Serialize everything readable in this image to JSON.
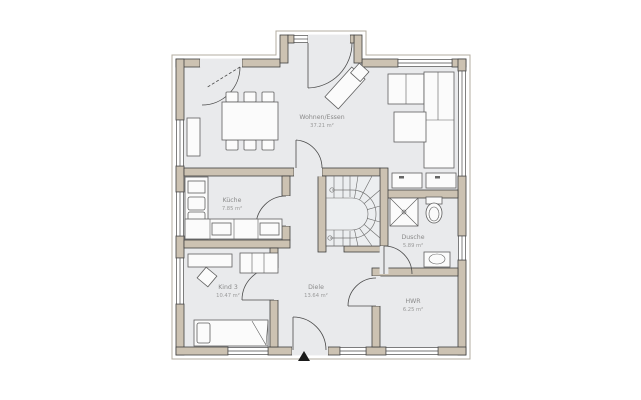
{
  "plan": {
    "rooms": [
      {
        "id": "wohnen-essen",
        "name": "Wohnen/Essen",
        "area": "37.21 m²"
      },
      {
        "id": "kueche",
        "name": "Küche",
        "area": "7.85 m²"
      },
      {
        "id": "kind-3",
        "name": "Kind 3",
        "area": "10.47 m²"
      },
      {
        "id": "diele",
        "name": "Diele",
        "area": "13.64 m²"
      },
      {
        "id": "dusche",
        "name": "Dusche",
        "area": "5.89 m²"
      },
      {
        "id": "hwr",
        "name": "HWR",
        "area": "6.25 m²"
      }
    ],
    "symbols": [
      {
        "name": "entrance-marker",
        "glyph": "▲",
        "color": "#1a1a1a"
      }
    ],
    "colors": {
      "wall_fill": "#ccc2b2",
      "wall_outline": "#3f3f3f",
      "floor": "#e9eaec",
      "furniture_outline": "#5f5f5f",
      "label_text": "#8a8a8a",
      "background": "#ffffff"
    }
  }
}
